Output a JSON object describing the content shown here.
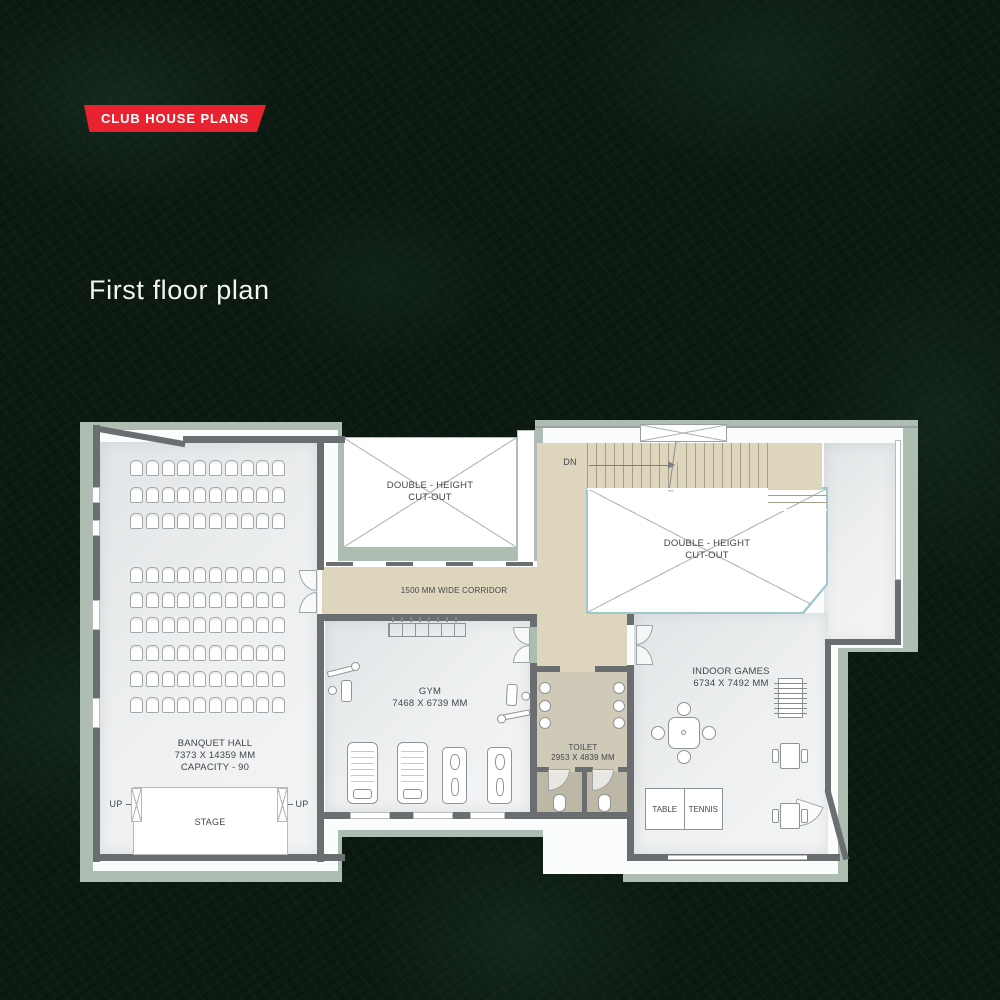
{
  "badge": {
    "label": "CLUB HOUSE PLANS"
  },
  "title": "First floor plan",
  "rooms": {
    "banquet": {
      "name": "BANQUET HALL",
      "dims": "7373 X 14359 MM",
      "capacity": "CAPACITY - 90"
    },
    "gym": {
      "name": "GYM",
      "dims": "7468 X 6739 MM"
    },
    "indoor_games": {
      "name": "INDOOR GAMES",
      "dims": "6734 X 7492 MM"
    },
    "toilet": {
      "name": "TOILET",
      "dims": "2953 X 4839 MM"
    }
  },
  "labels": {
    "corridor": "1500 MM WIDE CORRIDOR",
    "cutout_line1": "DOUBLE - HEIGHT",
    "cutout_line2": "CUT-OUT",
    "stage": "STAGE",
    "up": "UP",
    "dn": "DN",
    "table_tennis_left": "TABLE",
    "table_tennis_right": "TENNIS"
  },
  "colors": {
    "accent_red": "#e8232f",
    "plan_outline_sage": "#adbdb2",
    "wall_gray": "#6a6e71",
    "corridor_beige": "#ddd5bc",
    "floor_gray": "#eceeef",
    "toilet_floor": "#cfc9b7",
    "cutout_border": "#9fc8cd",
    "background_green": "#0c1a12"
  }
}
